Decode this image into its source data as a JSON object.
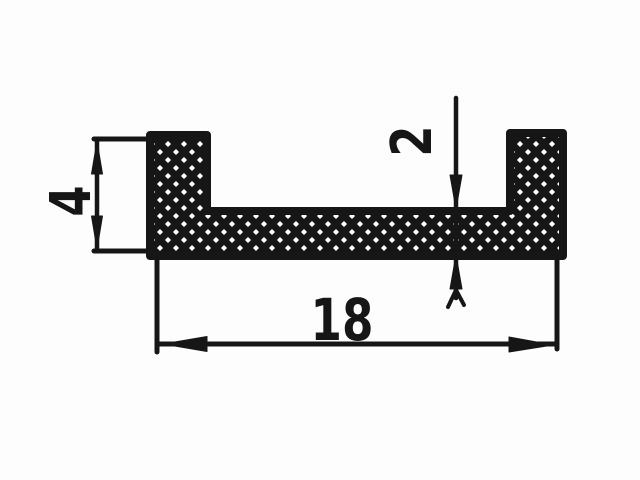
{
  "drawing": {
    "labels": {
      "overall_width": "18",
      "profile_height": "4",
      "web_thickness": "2"
    },
    "colors": {
      "ink": "#161616",
      "paper": "#fdfdfd"
    }
  }
}
